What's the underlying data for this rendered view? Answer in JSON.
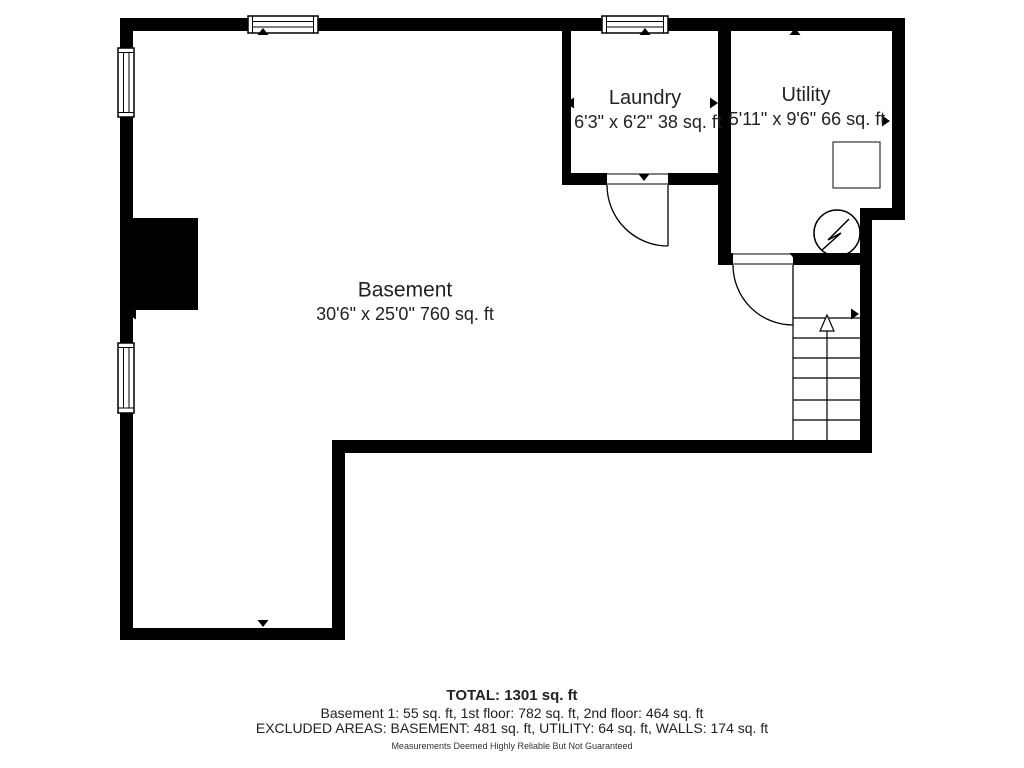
{
  "plan": {
    "rooms": [
      {
        "id": "basement",
        "label": "Basement",
        "dimensions": "30'6\" x 25'0\" 760 sq. ft"
      },
      {
        "id": "laundry",
        "label": "Laundry",
        "dimensions": "6'3\" x 6'2\" 38 sq. ft"
      },
      {
        "id": "utility",
        "label": "Utility",
        "dimensions": "5'11\" x 9'6\" 66 sq. ft"
      }
    ],
    "fixtures": [
      {
        "id": "stairs",
        "icon": "stairs-up-arrow-icon"
      },
      {
        "id": "electrical-panel",
        "icon": "circle-lightning-bolt-icon"
      },
      {
        "id": "water-heater",
        "icon": "square-outline-icon"
      },
      {
        "id": "chimney",
        "icon": "solid-block"
      }
    ],
    "summary": {
      "total": "TOTAL: 1301 sq. ft",
      "floors": "Basement 1: 55 sq. ft, 1st floor: 782 sq. ft, 2nd floor: 464 sq. ft",
      "excluded": "EXCLUDED AREAS: BASEMENT: 481 sq. ft, UTILITY: 64 sq. ft, WALLS: 174 sq. ft",
      "disclaimer": "Measurements Deemed Highly Reliable But Not Guaranteed"
    },
    "colors": {
      "walls": "#000000",
      "text": "#222222",
      "background": "#ffffff"
    }
  }
}
